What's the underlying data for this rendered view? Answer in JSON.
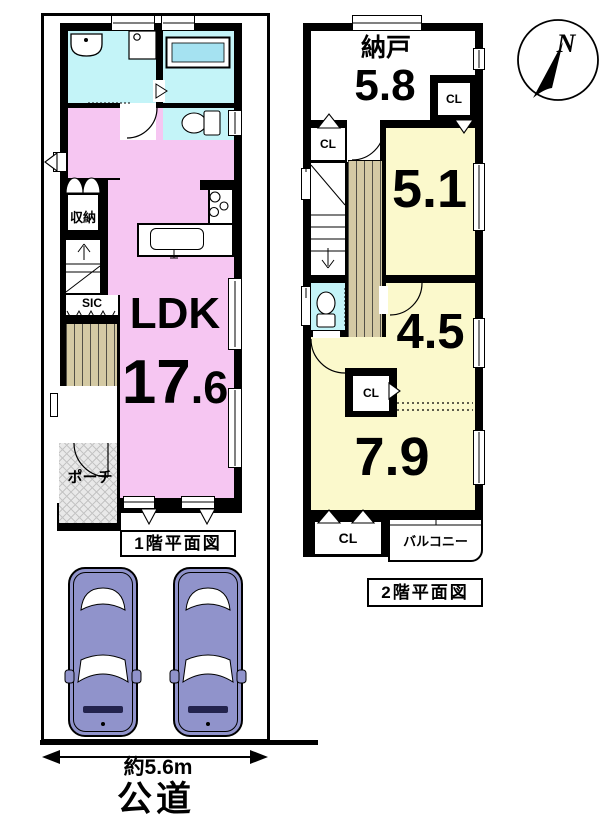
{
  "colors": {
    "ldk-pink": "#F6C6F2",
    "wet-cyan": "#C4F4F8",
    "room-yellow": "#FBF9CC",
    "wood-tan": "#D4CAA4",
    "bath-blue": "#A5E2F1",
    "car-purple": "#9093CB",
    "porch-gray": "#E9E9E9"
  },
  "compass": {
    "label": "N"
  },
  "floor1": {
    "caption": "1階平面図",
    "ldk": {
      "name": "LDK",
      "area_main": "17",
      "area_decimal": ".6"
    },
    "storage_label": "収納",
    "sic_label": "SIC",
    "porch_label": "ポーチ"
  },
  "floor2": {
    "caption": "2階平面図",
    "nando": {
      "name": "納戸",
      "area": "5.8"
    },
    "room_5_1": {
      "area": "5.1"
    },
    "room_4_5": {
      "area": "4.5"
    },
    "room_7_9": {
      "area": "7.9"
    },
    "closets": {
      "top": "CL",
      "left": "CL",
      "middle": "CL",
      "bottom": "CL"
    },
    "balcony_label": "バルコニー"
  },
  "site": {
    "width_label": "約5.6m",
    "road_label": "公道",
    "car_count": 2
  }
}
